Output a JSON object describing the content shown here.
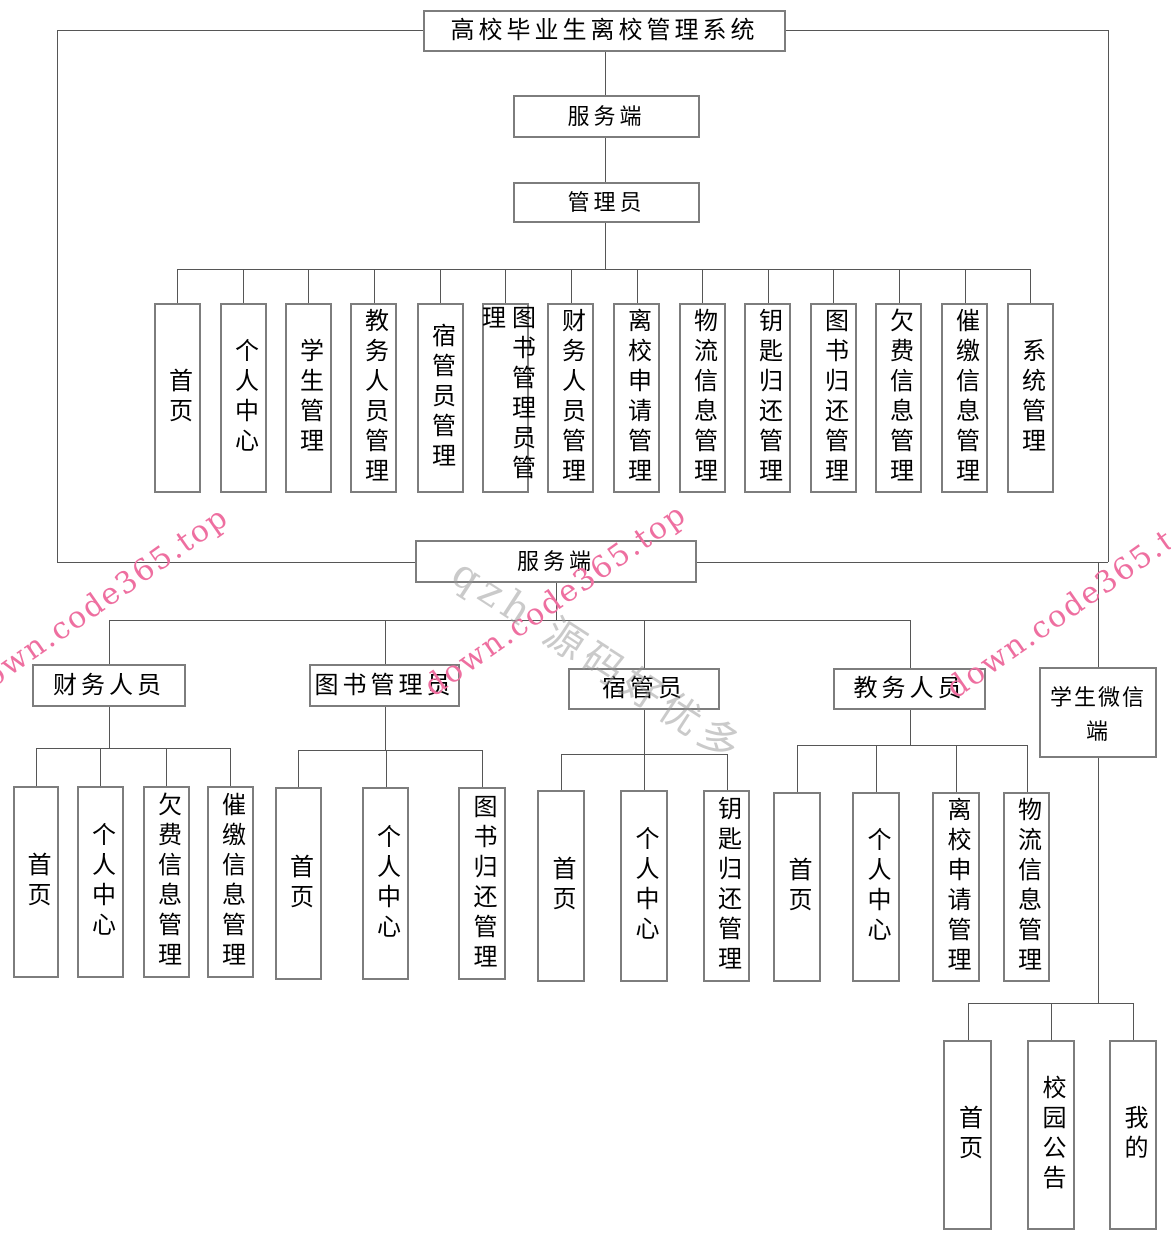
{
  "diagram": {
    "background_color": "#ffffff",
    "line_color": "#565656",
    "box_border_color": "#7d7d7d",
    "text_color": "#000000",
    "watermark_pink_color": "#ee6fa0",
    "watermark_gray_color": "rgba(150,150,150,0.5)",
    "nodes": [
      {
        "name": "root-title",
        "label": "高校毕业生离校管理系统",
        "x": 423,
        "y": 10,
        "w": 363,
        "h": 42,
        "mode": "h",
        "fs": 24
      },
      {
        "name": "server-top",
        "label": "服务端",
        "x": 513,
        "y": 95,
        "w": 187,
        "h": 43,
        "mode": "h",
        "fs": 22
      },
      {
        "name": "admin",
        "label": "管理员",
        "x": 513,
        "y": 182,
        "w": 187,
        "h": 41,
        "mode": "h",
        "fs": 22
      },
      {
        "name": "admin-home",
        "label": "首页",
        "x": 154,
        "y": 303,
        "w": 47,
        "h": 190,
        "mode": "v",
        "fs": 24
      },
      {
        "name": "admin-profile",
        "label": "个人中心",
        "x": 220,
        "y": 303,
        "w": 47,
        "h": 190,
        "mode": "v",
        "fs": 24
      },
      {
        "name": "admin-students",
        "label": "学生管理",
        "x": 285,
        "y": 303,
        "w": 47,
        "h": 190,
        "mode": "v",
        "fs": 24
      },
      {
        "name": "admin-academic-staff",
        "label": "教务人员管理",
        "x": 350,
        "y": 303,
        "w": 47,
        "h": 190,
        "mode": "v",
        "fs": 24
      },
      {
        "name": "admin-dorm-managers",
        "label": "宿管员管理",
        "x": 417,
        "y": 303,
        "w": 47,
        "h": 190,
        "mode": "v",
        "fs": 24
      },
      {
        "name": "admin-librarians",
        "label": "图书管理员管理",
        "x": 482,
        "y": 303,
        "w": 47,
        "h": 190,
        "mode": "v",
        "fs": 24
      },
      {
        "name": "admin-finance-staff",
        "label": "财务人员管理",
        "x": 547,
        "y": 303,
        "w": 47,
        "h": 190,
        "mode": "v",
        "fs": 24
      },
      {
        "name": "admin-leave-applications",
        "label": "离校申请管理",
        "x": 613,
        "y": 303,
        "w": 47,
        "h": 190,
        "mode": "v",
        "fs": 24
      },
      {
        "name": "admin-logistics-info",
        "label": "物流信息管理",
        "x": 679,
        "y": 303,
        "w": 47,
        "h": 190,
        "mode": "v",
        "fs": 24
      },
      {
        "name": "admin-key-return",
        "label": "钥匙归还管理",
        "x": 744,
        "y": 303,
        "w": 47,
        "h": 190,
        "mode": "v",
        "fs": 24
      },
      {
        "name": "admin-book-return",
        "label": "图书归还管理",
        "x": 810,
        "y": 303,
        "w": 47,
        "h": 190,
        "mode": "v",
        "fs": 24
      },
      {
        "name": "admin-arrears-info",
        "label": "欠费信息管理",
        "x": 875,
        "y": 303,
        "w": 47,
        "h": 190,
        "mode": "v",
        "fs": 24
      },
      {
        "name": "admin-payment-reminder",
        "label": "催缴信息管理",
        "x": 941,
        "y": 303,
        "w": 47,
        "h": 190,
        "mode": "v",
        "fs": 24
      },
      {
        "name": "admin-system",
        "label": "系统管理",
        "x": 1007,
        "y": 303,
        "w": 47,
        "h": 190,
        "mode": "v",
        "fs": 24
      },
      {
        "name": "server-bottom",
        "label": "服务端",
        "x": 415,
        "y": 540,
        "w": 282,
        "h": 43,
        "mode": "h",
        "fs": 22
      },
      {
        "name": "finance-staff",
        "label": "财务人员",
        "x": 32,
        "y": 664,
        "w": 154,
        "h": 43,
        "mode": "h",
        "fs": 24
      },
      {
        "name": "librarian",
        "label": "图书管理员",
        "x": 309,
        "y": 664,
        "w": 151,
        "h": 43,
        "mode": "h",
        "fs": 24
      },
      {
        "name": "dorm-manager",
        "label": "宿管员",
        "x": 568,
        "y": 668,
        "w": 152,
        "h": 42,
        "mode": "h",
        "fs": 24
      },
      {
        "name": "academic-staff",
        "label": "教务人员",
        "x": 833,
        "y": 668,
        "w": 153,
        "h": 42,
        "mode": "h",
        "fs": 24
      },
      {
        "name": "student-wechat",
        "label": "学生微信端",
        "x": 1039,
        "y": 667,
        "w": 118,
        "h": 91,
        "mode": "hw",
        "fs": 22
      },
      {
        "name": "finance-home",
        "label": "首页",
        "x": 13,
        "y": 786,
        "w": 46,
        "h": 192,
        "mode": "v",
        "fs": 24
      },
      {
        "name": "finance-profile",
        "label": "个人中心",
        "x": 77,
        "y": 786,
        "w": 47,
        "h": 192,
        "mode": "v",
        "fs": 24
      },
      {
        "name": "finance-arrears-info",
        "label": "欠费信息管理",
        "x": 143,
        "y": 786,
        "w": 47,
        "h": 192,
        "mode": "v",
        "fs": 24
      },
      {
        "name": "finance-payment-reminder",
        "label": "催缴信息管理",
        "x": 207,
        "y": 786,
        "w": 47,
        "h": 192,
        "mode": "v",
        "fs": 24
      },
      {
        "name": "librarian-home",
        "label": "首页",
        "x": 275,
        "y": 787,
        "w": 47,
        "h": 193,
        "mode": "v",
        "fs": 24
      },
      {
        "name": "librarian-profile",
        "label": "个人中心",
        "x": 362,
        "y": 787,
        "w": 47,
        "h": 193,
        "mode": "v",
        "fs": 24
      },
      {
        "name": "librarian-book-return",
        "label": "图书归还管理",
        "x": 458,
        "y": 787,
        "w": 48,
        "h": 193,
        "mode": "v",
        "fs": 24
      },
      {
        "name": "dorm-home",
        "label": "首页",
        "x": 537,
        "y": 790,
        "w": 48,
        "h": 192,
        "mode": "v",
        "fs": 24
      },
      {
        "name": "dorm-profile",
        "label": "个人中心",
        "x": 620,
        "y": 790,
        "w": 48,
        "h": 192,
        "mode": "v",
        "fs": 24
      },
      {
        "name": "dorm-key-return",
        "label": "钥匙归还管理",
        "x": 703,
        "y": 790,
        "w": 47,
        "h": 192,
        "mode": "v",
        "fs": 24
      },
      {
        "name": "academic-home",
        "label": "首页",
        "x": 773,
        "y": 792,
        "w": 48,
        "h": 190,
        "mode": "v",
        "fs": 24
      },
      {
        "name": "academic-profile",
        "label": "个人中心",
        "x": 852,
        "y": 792,
        "w": 48,
        "h": 190,
        "mode": "v",
        "fs": 24
      },
      {
        "name": "academic-leave-applications",
        "label": "离校申请管理",
        "x": 932,
        "y": 792,
        "w": 48,
        "h": 190,
        "mode": "v",
        "fs": 24
      },
      {
        "name": "academic-logistics-info",
        "label": "物流信息管理",
        "x": 1003,
        "y": 792,
        "w": 47,
        "h": 190,
        "mode": "v",
        "fs": 24
      },
      {
        "name": "wechat-home",
        "label": "首页",
        "x": 943,
        "y": 1040,
        "w": 49,
        "h": 190,
        "mode": "v",
        "fs": 24
      },
      {
        "name": "wechat-campus-notice",
        "label": "校园公告",
        "x": 1027,
        "y": 1040,
        "w": 48,
        "h": 190,
        "mode": "v",
        "fs": 24
      },
      {
        "name": "wechat-mine",
        "label": "我的",
        "x": 1109,
        "y": 1040,
        "w": 48,
        "h": 190,
        "mode": "v",
        "fs": 24
      }
    ],
    "edges": [
      [
        57,
        30,
        423,
        30
      ],
      [
        786,
        30,
        1108,
        30
      ],
      [
        57,
        30,
        57,
        562
      ],
      [
        1108,
        30,
        1108,
        562
      ],
      [
        57,
        562,
        415,
        562
      ],
      [
        697,
        562,
        1108,
        562
      ],
      [
        1098,
        562,
        1098,
        667
      ],
      [
        605,
        52,
        605,
        95
      ],
      [
        605,
        138,
        605,
        182
      ],
      [
        605,
        223,
        605,
        269
      ],
      [
        177,
        269,
        1030,
        269
      ],
      [
        177,
        269,
        177,
        303
      ],
      [
        243,
        269,
        243,
        303
      ],
      [
        308,
        269,
        308,
        303
      ],
      [
        374,
        269,
        374,
        303
      ],
      [
        440,
        269,
        440,
        303
      ],
      [
        505,
        269,
        505,
        303
      ],
      [
        571,
        269,
        571,
        303
      ],
      [
        637,
        269,
        637,
        303
      ],
      [
        702,
        269,
        702,
        303
      ],
      [
        768,
        269,
        768,
        303
      ],
      [
        833,
        269,
        833,
        303
      ],
      [
        899,
        269,
        899,
        303
      ],
      [
        965,
        269,
        965,
        303
      ],
      [
        1030,
        269,
        1030,
        303
      ],
      [
        556,
        583,
        556,
        620
      ],
      [
        109,
        620,
        910,
        620
      ],
      [
        109,
        620,
        109,
        664
      ],
      [
        385,
        620,
        385,
        664
      ],
      [
        644,
        620,
        644,
        668
      ],
      [
        910,
        620,
        910,
        668
      ],
      [
        109,
        707,
        109,
        748
      ],
      [
        36,
        748,
        230,
        748
      ],
      [
        36,
        748,
        36,
        786
      ],
      [
        100,
        748,
        100,
        786
      ],
      [
        166,
        748,
        166,
        786
      ],
      [
        230,
        748,
        230,
        786
      ],
      [
        385,
        707,
        385,
        750
      ],
      [
        298,
        750,
        482,
        750
      ],
      [
        298,
        750,
        298,
        787
      ],
      [
        386,
        750,
        386,
        787
      ],
      [
        482,
        750,
        482,
        787
      ],
      [
        644,
        710,
        644,
        754
      ],
      [
        561,
        754,
        727,
        754
      ],
      [
        561,
        754,
        561,
        790
      ],
      [
        644,
        754,
        644,
        790
      ],
      [
        727,
        754,
        727,
        790
      ],
      [
        910,
        710,
        910,
        745
      ],
      [
        797,
        745,
        1027,
        745
      ],
      [
        797,
        745,
        797,
        792
      ],
      [
        876,
        745,
        876,
        792
      ],
      [
        956,
        745,
        956,
        792
      ],
      [
        1027,
        745,
        1027,
        792
      ],
      [
        1098,
        758,
        1098,
        1003
      ],
      [
        968,
        1003,
        1133,
        1003
      ],
      [
        968,
        1003,
        968,
        1040
      ],
      [
        1051,
        1003,
        1051,
        1040
      ],
      [
        1133,
        1003,
        1133,
        1040
      ]
    ],
    "watermarks": [
      {
        "name": "watermark-pink-left",
        "text": "down.code365.top",
        "x": -30,
        "y": 675,
        "angle": -35,
        "color": "#ee6fa0",
        "fs": 30,
        "ls": 2
      },
      {
        "name": "watermark-pink-middle",
        "text": "down.code365.top",
        "x": 428,
        "y": 672,
        "angle": -35,
        "color": "#ee6fa0",
        "fs": 30,
        "ls": 2
      },
      {
        "name": "watermark-pink-right",
        "text": "down.code365.top",
        "x": 950,
        "y": 674,
        "angle": -35,
        "color": "#ee6fa0",
        "fs": 30,
        "ls": 2
      },
      {
        "name": "watermark-gray-middle",
        "text": "qzh 源码好优多",
        "x": 458,
        "y": 537,
        "angle": 33,
        "color": "rgba(150,150,150,0.5)",
        "fs": 40,
        "ls": 6
      }
    ]
  }
}
